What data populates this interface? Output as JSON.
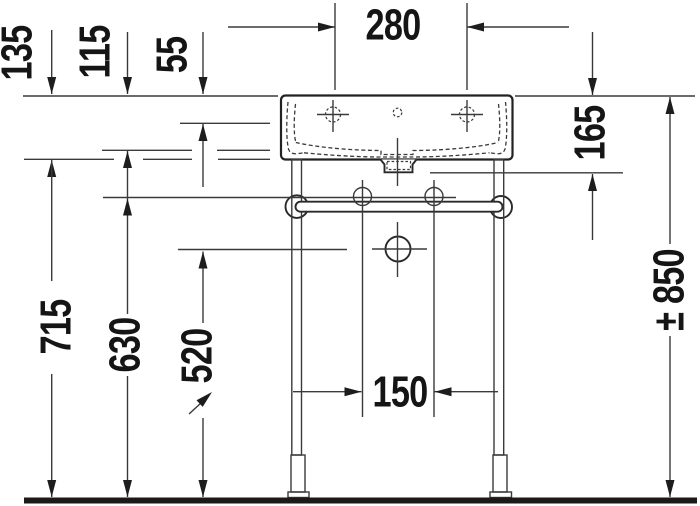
{
  "drawing": {
    "colors": {
      "line": "#3a3a3a",
      "outline": "#222222",
      "text": "#151515",
      "floor": "#1a1a1a",
      "background": "#ffffff"
    },
    "dimensions": {
      "d280": {
        "label": "280"
      },
      "d135": {
        "label": "135"
      },
      "d115": {
        "label": "115"
      },
      "d55": {
        "label": "55"
      },
      "d165": {
        "label": "165"
      },
      "d715": {
        "label": "715"
      },
      "d630": {
        "label": "630"
      },
      "d520": {
        "label": "520"
      },
      "d150": {
        "label": "150"
      },
      "d850": {
        "label": "± 850"
      }
    }
  }
}
